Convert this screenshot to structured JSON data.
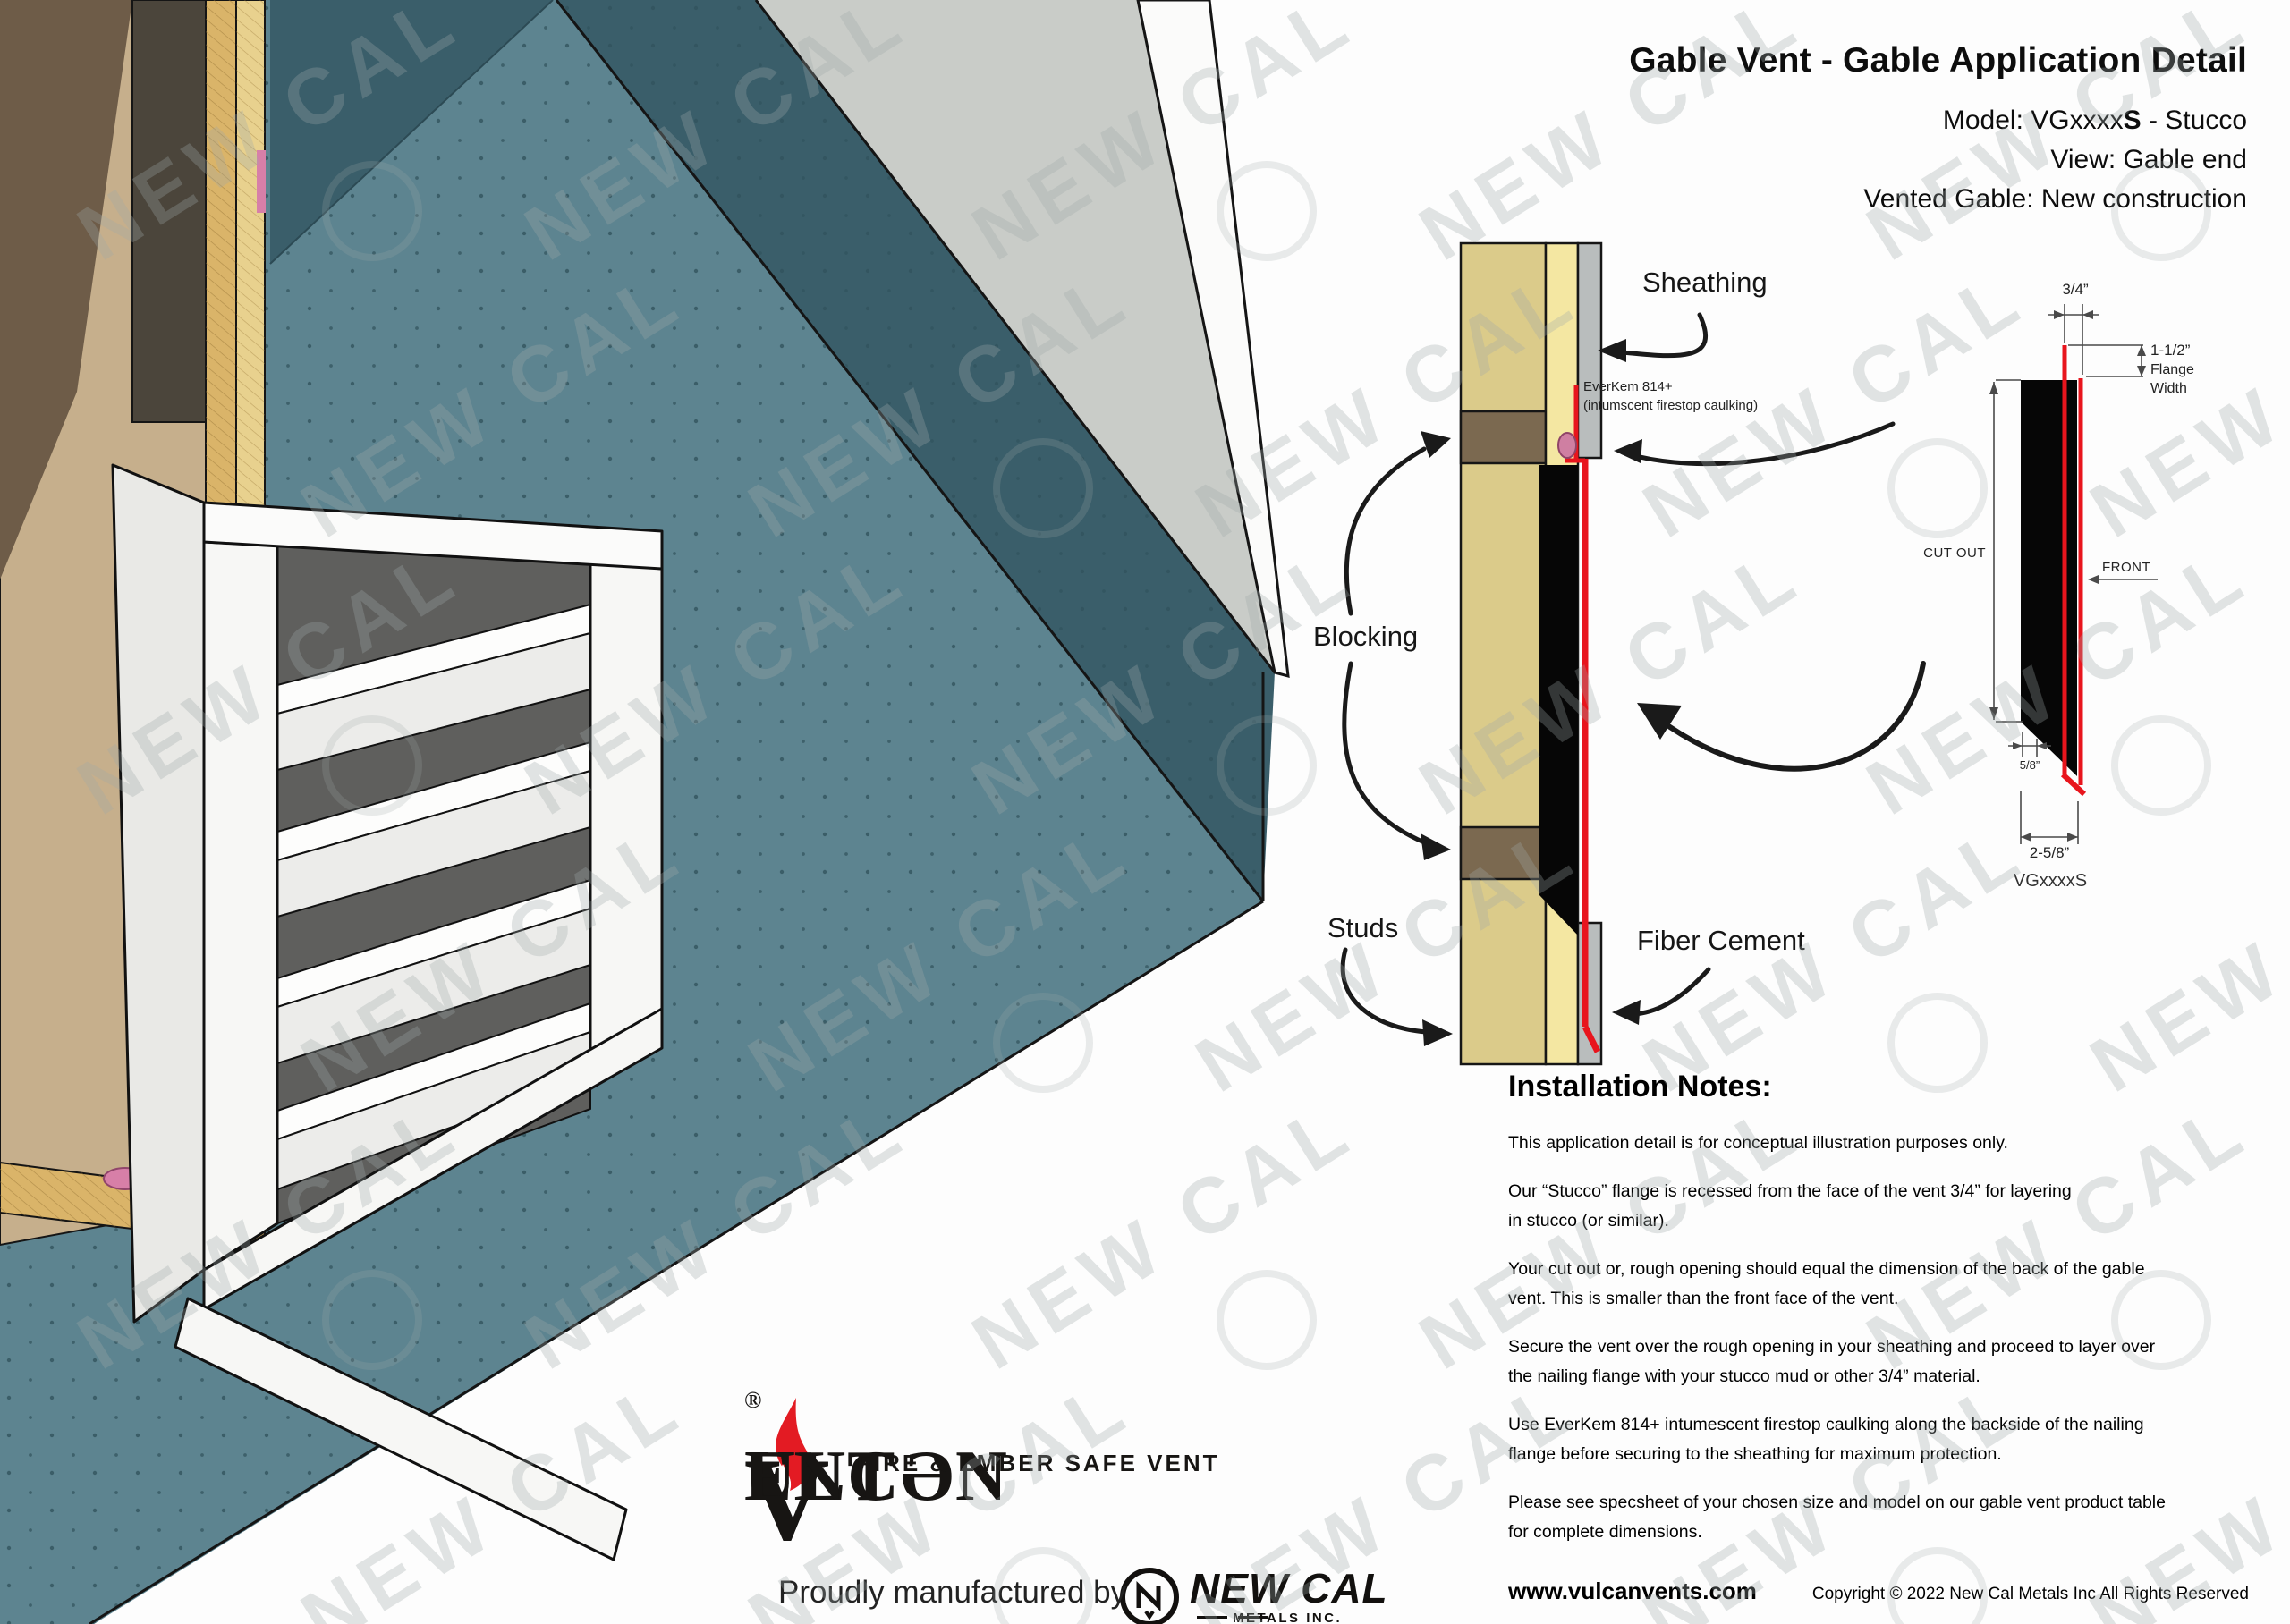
{
  "watermark": {
    "text": "NEW CAL"
  },
  "header": {
    "title": "Gable Vent - Gable Application Detail",
    "model_prefix": "Model: VGxxxx",
    "model_bold": "S",
    "model_suffix": " - Stucco",
    "view_line": "View: Gable end",
    "vented_line": "Vented Gable: New construction"
  },
  "cross_section": {
    "labels": {
      "sheathing": "Sheathing",
      "everkem_line1": "EverKem 814+",
      "everkem_line2": "(intumscent firestop caulking)",
      "blocking": "Blocking",
      "studs": "Studs",
      "fiber_cement": "Fiber Cement"
    }
  },
  "profile_diagram": {
    "model_label": "VGxxxxS",
    "dims": {
      "recess": "3/4”",
      "flange_width_value": "1-1/2”",
      "flange_width_label1": "Flange",
      "flange_width_label2": "Width",
      "cut_out": "CUT OUT",
      "front": "FRONT",
      "bottom_offset": "5/8”",
      "depth": "2-5/8”"
    }
  },
  "notes": {
    "heading": "Installation Notes:",
    "paragraphs": [
      "This application detail is for conceptual illustration  purposes only.",
      "Our “Stucco” flange is recessed from the face of the vent 3/4” for layering\nin stucco (or similar).",
      "Your cut out or, rough opening should equal the dimension of the back of the gable\nvent. This is smaller than the front face of the vent.",
      "Secure the vent over the rough opening in your sheathing and proceed to layer over\nthe nailing flange with your stucco mud or other 3/4” material.",
      "Use EverKem 814+ intumescent firestop caulking along the backside of the nailing\nflange before securing to the sheathing for maximum protection.",
      "Please see specsheet of your chosen size and model on our gable vent product table\nfor complete dimensions."
    ]
  },
  "footer": {
    "website": "www.vulcanvents.com",
    "copyright": "Copyright © 2022 New Cal Metals Inc All Rights Reserved"
  },
  "branding": {
    "tagline": "FIRE & EMBER SAFE VENT",
    "brand_v1": "V",
    "brand_mid": "ULCƏN ",
    "brand_v2": "V",
    "brand_end": "ENT",
    "reg": "®",
    "proudly": "Proudly manufactured by",
    "newcal_name": "NEW CAL",
    "newcal_sub": "METALS INC."
  },
  "colors": {
    "wall_teal": "#5d8490",
    "wall_teal_dark": "#3a5e6a",
    "roof_gray": "#c9ccc8",
    "stud_tan": "#dbcb8a",
    "sheathing_yellow": "#f4e7a2",
    "fiber_cement_gray": "#b9bdbd",
    "blocking_brown": "#7b6950",
    "flange_red": "#e8151d",
    "caulk_pink": "#cf7fa2",
    "flame_red": "#e31b23"
  }
}
